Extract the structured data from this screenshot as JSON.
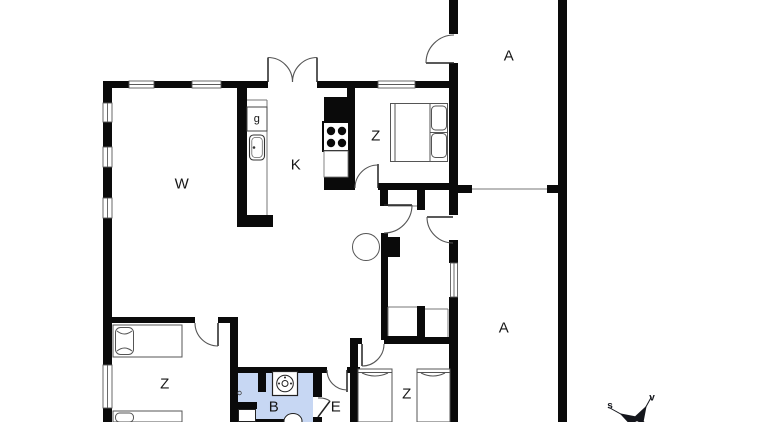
{
  "floorplan": {
    "rooms": [
      {
        "id": "living-room",
        "label": "W"
      },
      {
        "id": "kitchen",
        "label": "K"
      },
      {
        "id": "kitchen-cabinet",
        "label": "g"
      },
      {
        "id": "bedroom-north",
        "label": "Z"
      },
      {
        "id": "terrace-north",
        "label": "A"
      },
      {
        "id": "terrace-south",
        "label": "A"
      },
      {
        "id": "bedroom-west",
        "label": "Z"
      },
      {
        "id": "bathroom",
        "label": "B"
      },
      {
        "id": "entry",
        "label": "E"
      },
      {
        "id": "bedroom-south",
        "label": "Z"
      }
    ],
    "compass": {
      "south_label": "s",
      "west_label": "v"
    },
    "colors": {
      "wall": "#0a0a0a",
      "bathroom_fill": "#c7d7f3",
      "thin_line": "#555555"
    }
  }
}
